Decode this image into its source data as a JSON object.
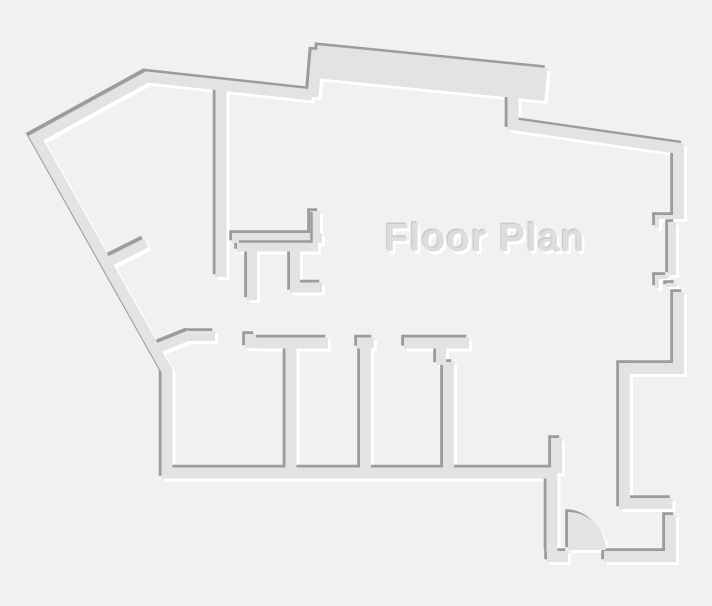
{
  "title": "Floor Plan",
  "canvas": {
    "width": 712,
    "height": 606
  },
  "colors": {
    "background": "#f0f1f1",
    "wall_fill": "#e2e3e4",
    "edge_shadow": "#9a9c9e",
    "edge_highlight": "#ffffff",
    "title_fill": "#dbdddf",
    "title_shadow": "#c8cacc",
    "title_highlight": "#ffffff"
  },
  "emboss": {
    "highlight_dx": 3,
    "highlight_dy": 3,
    "shadow_dx": -2.8,
    "shadow_dy": -2.8
  },
  "title_pos": {
    "x": 485,
    "y": 251
  },
  "walls": [
    {
      "name": "outer-wall",
      "d": "M 312 95 L 147 77 L 36 138 L 167 371 L 167 473 L 552 473 L 552 552",
      "w": 11
    },
    {
      "name": "top-jog-wall",
      "d": "M 313 97 L 317 50",
      "w": 11
    },
    {
      "name": "balcony-slab",
      "d": "M 316 61.5 L 546 84.5",
      "w": 33
    },
    {
      "name": "top-step-wall",
      "d": "M 513 93 L 513 127",
      "w": 11
    },
    {
      "name": "top-right-wall",
      "d": "M 508 124 L 683 149",
      "w": 11
    },
    {
      "name": "right-wall-upper",
      "d": "M 678.5 144 L 678.5 219",
      "w": 11
    },
    {
      "name": "window-sill",
      "d": "M 672 222 L 672 275",
      "w": 8
    },
    {
      "name": "window-bracket-top-h",
      "d": "M 655 217 L 676 217",
      "w": 4
    },
    {
      "name": "window-bracket-top-v",
      "d": "M 657 215 L 657 228",
      "w": 4
    },
    {
      "name": "window-bracket-bottom-h",
      "d": "M 655 277 L 668 277",
      "w": 4
    },
    {
      "name": "window-bracket-bottom-v",
      "d": "M 657 275 L 657 288",
      "w": 4
    },
    {
      "name": "window-bracket-bottom-h2",
      "d": "M 666 285 L 676.5 285",
      "w": 4
    },
    {
      "name": "right-wall-lower",
      "d": "M 678.5 292 L 678.5 368.5 L 624.5 368.5",
      "w": 11
    },
    {
      "name": "entry-right-wall",
      "d": "M 624.5 363 L 624.5 503.5 L 672.5 503.5",
      "w": 11
    },
    {
      "name": "entry-step-wall",
      "d": "M 670.5 515 L 670.5 556.5 L 604 556.5",
      "w": 11
    },
    {
      "name": "entry-bottom-left-wall",
      "d": "M 547 556.5 L 568 556.5",
      "w": 11
    },
    {
      "name": "hall-stub-wall",
      "d": "M 556.5 438 L 556.5 473",
      "w": 11
    },
    {
      "name": "interior-wall-vertical",
      "d": "M 221 90 L 221 277",
      "w": 11
    },
    {
      "name": "kitchen-wall",
      "d": "M 232 238 L 322 238",
      "w": 10
    },
    {
      "name": "kitchen-counter",
      "d": "M 237 247 L 318 247",
      "w": 9
    },
    {
      "name": "kitchen-wall-right",
      "d": "M 315 211 L 315 243",
      "w": 10
    },
    {
      "name": "kitchen-stub-wall",
      "d": "M 252 249 L 252 300",
      "w": 10
    },
    {
      "name": "kitchen-l-wall",
      "d": "M 295 249 L 295 287.5 L 322 287.5",
      "w": 10
    },
    {
      "name": "closet-stub-wall",
      "d": "M 108 262 L 146 243",
      "w": 10
    },
    {
      "name": "diagonal-connector-wall",
      "d": "M 158 348 L 190 335",
      "w": 10
    },
    {
      "name": "room1-lintel",
      "d": "M 188 336 L 215 336",
      "w": 10
    },
    {
      "name": "room2-step",
      "d": "M 250.5 334 L 250.5 348",
      "w": 11
    },
    {
      "name": "room2-top-wall",
      "d": "M 256 343 L 328 343",
      "w": 11
    },
    {
      "name": "divider-wall-1",
      "d": "M 291 348 L 291 473",
      "w": 11
    },
    {
      "name": "room3-lintel",
      "d": "M 357 343 L 374 343",
      "w": 11
    },
    {
      "name": "divider-wall-2",
      "d": "M 365.5 348 L 365.5 473",
      "w": 11
    },
    {
      "name": "room4-top-wall",
      "d": "M 404 343 L 469 343",
      "w": 11
    },
    {
      "name": "divider-3-stub",
      "d": "M 441 348 L 441 365",
      "w": 10
    },
    {
      "name": "divider-wall-3",
      "d": "M 448.5 362 L 448.5 473",
      "w": 11
    }
  ],
  "door": {
    "swing_path": "M 568 512 A 38 38 0 0 1 606 550 L 568 550 Z"
  },
  "counter_edge_path": "M 311.5 212 L 311.5 241.5 L 239 241.5"
}
